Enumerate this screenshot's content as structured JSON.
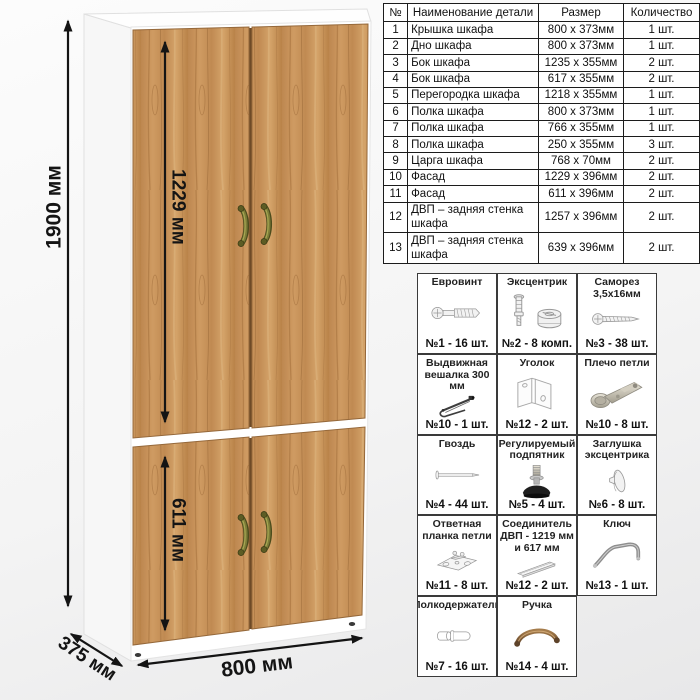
{
  "drawing": {
    "dims": {
      "height": "1900 мм",
      "upper": "1229 мм",
      "lower": "611 мм",
      "width": "800 мм",
      "depth": "375 мм"
    },
    "colors": {
      "door_wood": "#c6905a",
      "carcass": "#ffffff",
      "handle": "#7c7c38",
      "dimension_lines": "#141414"
    }
  },
  "parts_table": {
    "headers": {
      "num": "№",
      "name": "Наименование детали",
      "size": "Размер",
      "qty": "Количество"
    },
    "rows": [
      {
        "n": "1",
        "name": "Крышка шкафа",
        "size": "800 х 373мм",
        "qty": "1 шт."
      },
      {
        "n": "2",
        "name": "Дно шкафа",
        "size": "800 х 373мм",
        "qty": "1 шт."
      },
      {
        "n": "3",
        "name": "Бок шкафа",
        "size": "1235 х 355мм",
        "qty": "2 шт."
      },
      {
        "n": "4",
        "name": "Бок шкафа",
        "size": "617 х 355мм",
        "qty": "2 шт."
      },
      {
        "n": "5",
        "name": "Перегородка шкафа",
        "size": "1218 х 355мм",
        "qty": "1 шт."
      },
      {
        "n": "6",
        "name": "Полка шкафа",
        "size": "800 х 373мм",
        "qty": "1 шт."
      },
      {
        "n": "7",
        "name": "Полка шкафа",
        "size": "766 х 355мм",
        "qty": "1 шт."
      },
      {
        "n": "8",
        "name": "Полка шкафа",
        "size": "250 х 355мм",
        "qty": "3 шт."
      },
      {
        "n": "9",
        "name": "Царга шкафа",
        "size": "768 х 70мм",
        "qty": "2 шт."
      },
      {
        "n": "10",
        "name": "Фасад",
        "size": "1229 х 396мм",
        "qty": "2 шт."
      },
      {
        "n": "11",
        "name": "Фасад",
        "size": "611 х 396мм",
        "qty": "2 шт."
      },
      {
        "n": "12",
        "name": "ДВП – задняя стенка шкафа",
        "size": "1257 х 396мм",
        "qty": "2 шт."
      },
      {
        "n": "13",
        "name": "ДВП – задняя стенка шкафа",
        "size": "639 х 396мм",
        "qty": "2 шт."
      }
    ]
  },
  "hardware": {
    "items": [
      {
        "name": "Евровинт",
        "qty": "№1 - 16 шт.",
        "icon": "euro-screw-icon"
      },
      {
        "name": "Эксцентрик",
        "qty": "№2 - 8 комп.",
        "icon": "cam-lock-icon"
      },
      {
        "name": "Саморез 3,5х16мм",
        "qty": "№3 - 38 шт.",
        "icon": "self-tapping-screw-icon"
      },
      {
        "name": "Выдвижная вешалка 300 мм",
        "qty": "№10 - 1 шт.",
        "icon": "pullout-hanger-icon"
      },
      {
        "name": "Уголок",
        "qty": "№12 - 2 шт.",
        "icon": "corner-bracket-icon"
      },
      {
        "name": "Плечо петли",
        "qty": "№10 - 8 шт.",
        "icon": "hinge-arm-icon"
      },
      {
        "name": "Гвоздь",
        "qty": "№4 - 44 шт.",
        "icon": "nail-icon"
      },
      {
        "name": "Регулируемый подпятник",
        "qty": "№5 - 4 шт.",
        "icon": "adjustable-foot-icon"
      },
      {
        "name": "Заглушка эксцентрика",
        "qty": "№6 - 8 шт.",
        "icon": "cam-cover-icon"
      },
      {
        "name": "Ответная планка петли",
        "qty": "№11 - 8 шт.",
        "icon": "hinge-plate-icon"
      },
      {
        "name": "Соединитель ДВП - 1219 мм и 617 мм",
        "qty": "№12 - 2 шт.",
        "icon": "hdf-connector-icon"
      },
      {
        "name": "Ключ",
        "qty": "№13 - 1 шт.",
        "icon": "hex-key-icon"
      },
      {
        "name": "Полкодержатель",
        "qty": "№7 - 16 шт.",
        "icon": "shelf-pin-icon"
      },
      {
        "name": "Ручка",
        "qty": "№14 - 4 шт.",
        "icon": "handle-icon"
      }
    ]
  }
}
